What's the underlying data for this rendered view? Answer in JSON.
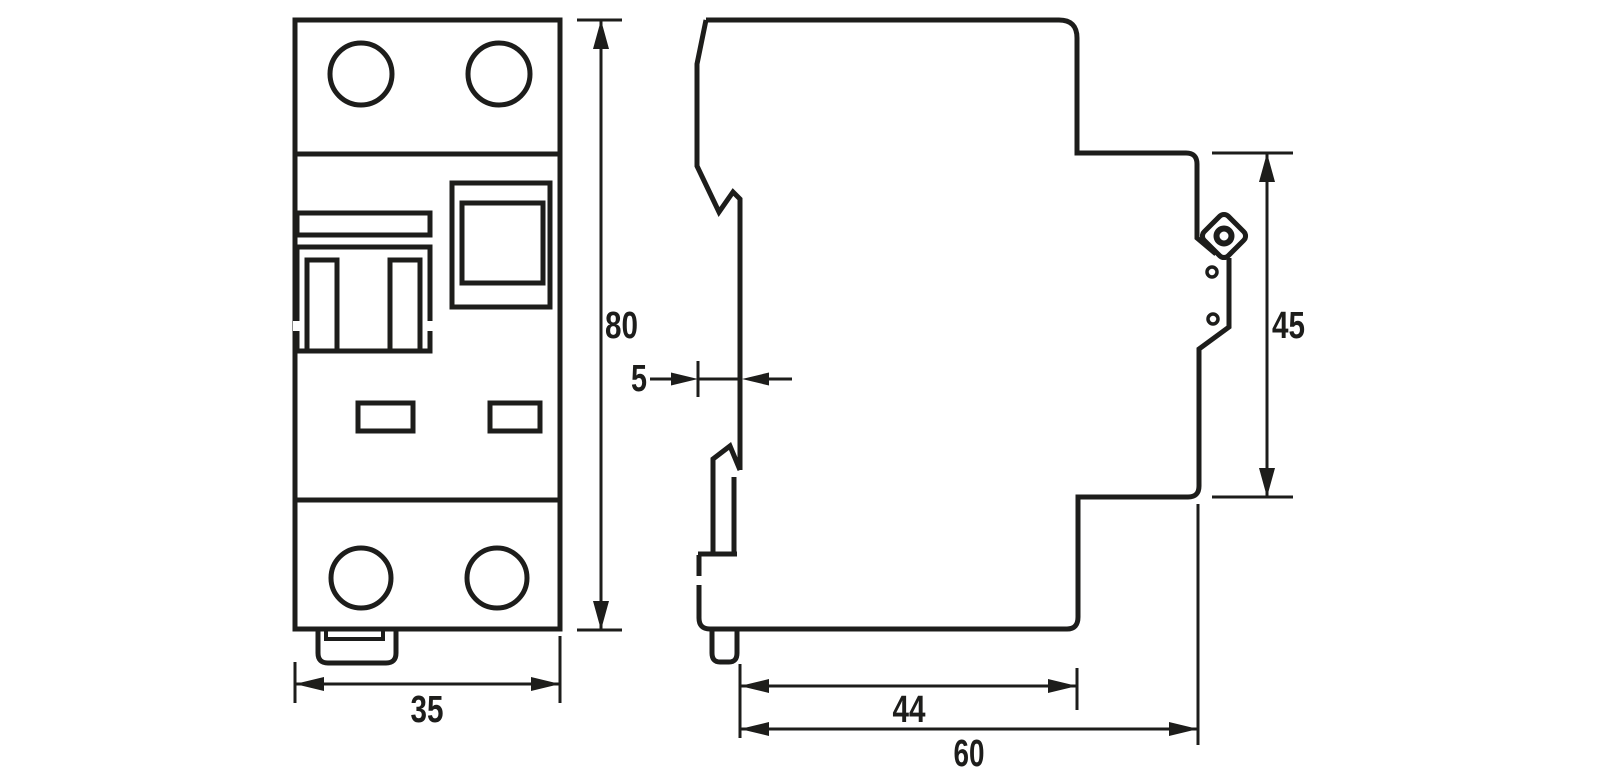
{
  "drawing": {
    "kind": "technical dimension drawing, DIN-rail modular circuit breaker, front and side views",
    "colors": {
      "line": "#1d1d1b",
      "background": "#ffffff"
    },
    "dimensions": {
      "width": {
        "value": "35"
      },
      "height": {
        "value": "80"
      },
      "rail_recess": {
        "value": "5"
      },
      "front_height": {
        "value": "45"
      },
      "base_depth": {
        "value": "44"
      },
      "total_depth": {
        "value": "60"
      }
    }
  }
}
